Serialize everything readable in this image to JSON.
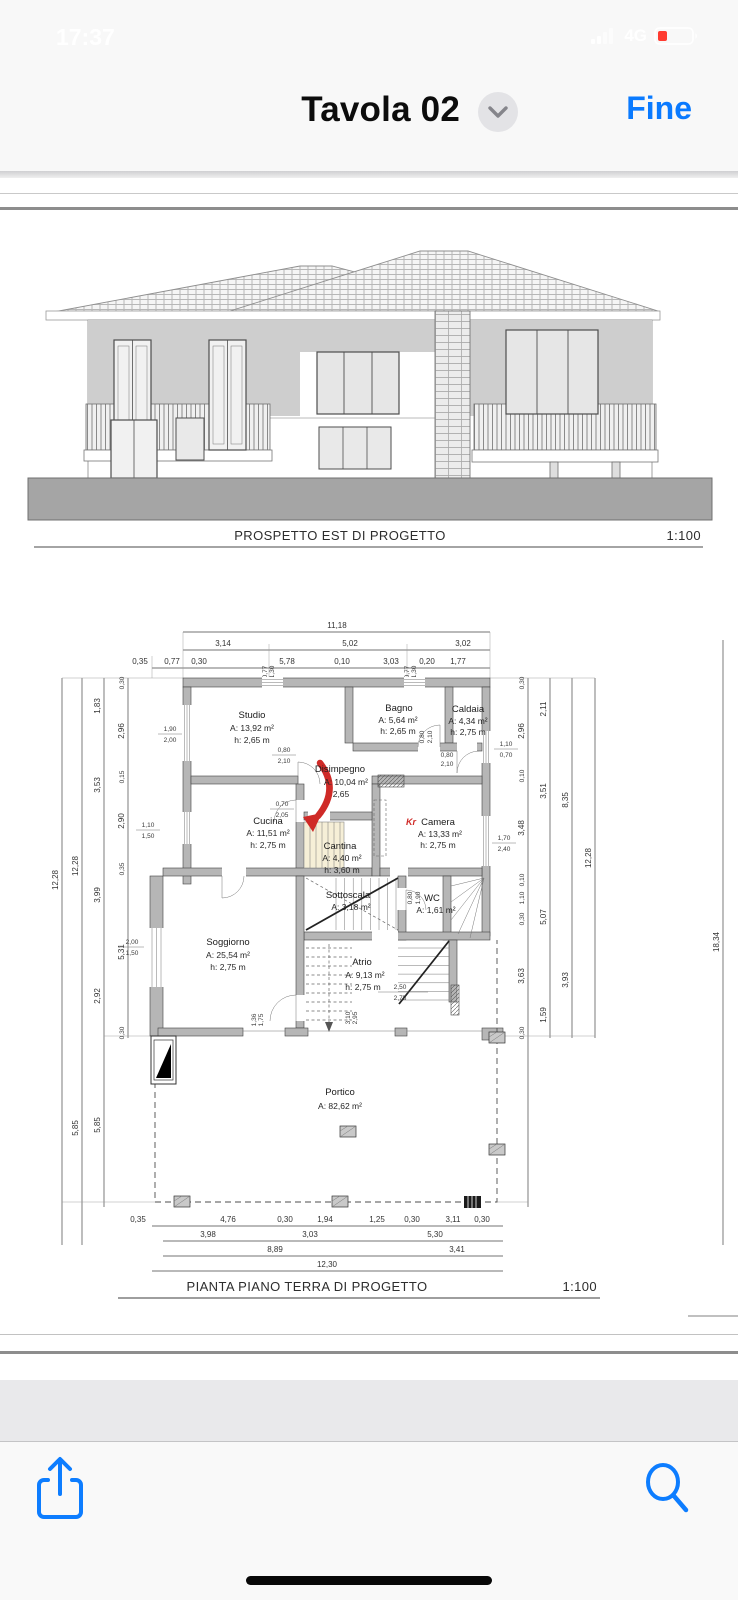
{
  "status_bar": {
    "time": "17:37",
    "network": "4G"
  },
  "nav_bar": {
    "title": "Tavola 02",
    "done_label": "Fine"
  },
  "icons": {
    "chevron": "chevron-down-icon",
    "signal": "cellular-signal-icon",
    "battery": "battery-low-icon",
    "share": "share-icon",
    "search": "search-icon"
  },
  "colors": {
    "accent": "#0a7aff",
    "annotation_red": "#cf2a27",
    "battery_red": "#ff3b30",
    "wall_grey": "#b6b6b6"
  },
  "pdf": {
    "elevation": {
      "caption": "PROSPETTO EST DI PROGETTO",
      "scale": "1:100"
    },
    "plan": {
      "caption": "PIANTA PIANO TERRA DI PROGETTO",
      "scale": "1:100",
      "camera_mark": "Kr",
      "rooms": {
        "studio": {
          "name": "Studio",
          "area": "A: 13,92 m²",
          "height": "h: 2,65 m"
        },
        "bagno": {
          "name": "Bagno",
          "area": "A: 5,64 m²",
          "height": "h: 2,65 m"
        },
        "caldaia": {
          "name": "Caldaia",
          "area": "A: 4,34 m²",
          "height": "h: 2,75 m"
        },
        "disimpegno": {
          "name": "Disimpegno",
          "area": "A: 10,04 m²",
          "height": "2,65"
        },
        "cucina": {
          "name": "Cucina",
          "area": "A: 11,51 m²",
          "height": "h: 2,75 m"
        },
        "cantina": {
          "name": "Cantina",
          "area": "A: 4,40 m²",
          "height": "h: 3,60 m"
        },
        "camera": {
          "name": "Camera",
          "area": "A: 13,33 m²",
          "height": "h: 2,75 m"
        },
        "sottoscala": {
          "name": "Sottoscala",
          "area": "A: 3,18 m²"
        },
        "wc": {
          "name": "WC",
          "area": "A: 1,61 m²"
        },
        "soggiorno": {
          "name": "Soggiorno",
          "area": "A: 25,54 m²",
          "height": "h: 2,75 m"
        },
        "atrio": {
          "name": "Atrio",
          "area": "A: 9,13 m²",
          "height": "h: 2,75 m"
        },
        "portico": {
          "name": "Portico",
          "area": "A: 82,62 m²"
        }
      },
      "dims": {
        "top_total": "11,18",
        "top_mid": [
          "3,14",
          "5,02",
          "3,02"
        ],
        "top_detail": [
          "0,35",
          "0,77",
          "0,30",
          "5,78",
          "0,10",
          "3,03",
          "0,20",
          "1,77"
        ],
        "top_window": [
          "0,77",
          "1,30"
        ],
        "bottom_detail": [
          "0,35",
          "4,76",
          "0,30",
          "1,94",
          "1,25",
          "0,30",
          "3,11",
          "0,30"
        ],
        "bottom_mid": [
          "3,98",
          "3,03",
          "5,30"
        ],
        "bottom_sub": [
          "8,89",
          "3,41"
        ],
        "bottom_total": "12,30",
        "left_total": [
          "12,28",
          "12,28"
        ],
        "left_mid": [
          "1,83",
          "3,53",
          "3,99",
          "2,92"
        ],
        "left_inner": [
          "0,30",
          "2,96",
          "0,15",
          "2,90",
          "0,35",
          "5,31",
          "0,30"
        ],
        "left_portico": [
          "5,85",
          "5,85"
        ],
        "right_inner": [
          "0,30",
          "2,96",
          "0,10",
          "3,48",
          "0,10",
          "1,10",
          "0,30",
          "3,63",
          "0,30"
        ],
        "right_mid": [
          "2,11",
          "3,51",
          "5,07",
          "1,59"
        ],
        "right_sub": [
          "8,35",
          "3,93"
        ],
        "right_total": "12,28",
        "overall_depth": "18,34",
        "details": {
          "studio_window": [
            "1,90",
            "2,00"
          ],
          "cucina_window": [
            "1,10",
            "1,50"
          ],
          "soggiorno_window": [
            "2,00",
            "1,50"
          ],
          "caldaia_window": [
            "1,10",
            "0,70"
          ],
          "camera_window": [
            "1,70",
            "2,40"
          ],
          "studio_door": [
            "0,80",
            "2,10"
          ],
          "bagno_door": [
            "0,80",
            "2,10"
          ],
          "caldaia_door": [
            "0,80",
            "2,10"
          ],
          "cucina_door": [
            "0,70",
            "2,05"
          ],
          "wc_door": [
            "0,80",
            "1,90"
          ],
          "atrio_right": [
            "2,50",
            "2,75"
          ],
          "soggiorno_opening": [
            "1,36",
            "1,75"
          ],
          "atrio_opening": [
            "3,10",
            "2,95"
          ]
        }
      }
    }
  }
}
